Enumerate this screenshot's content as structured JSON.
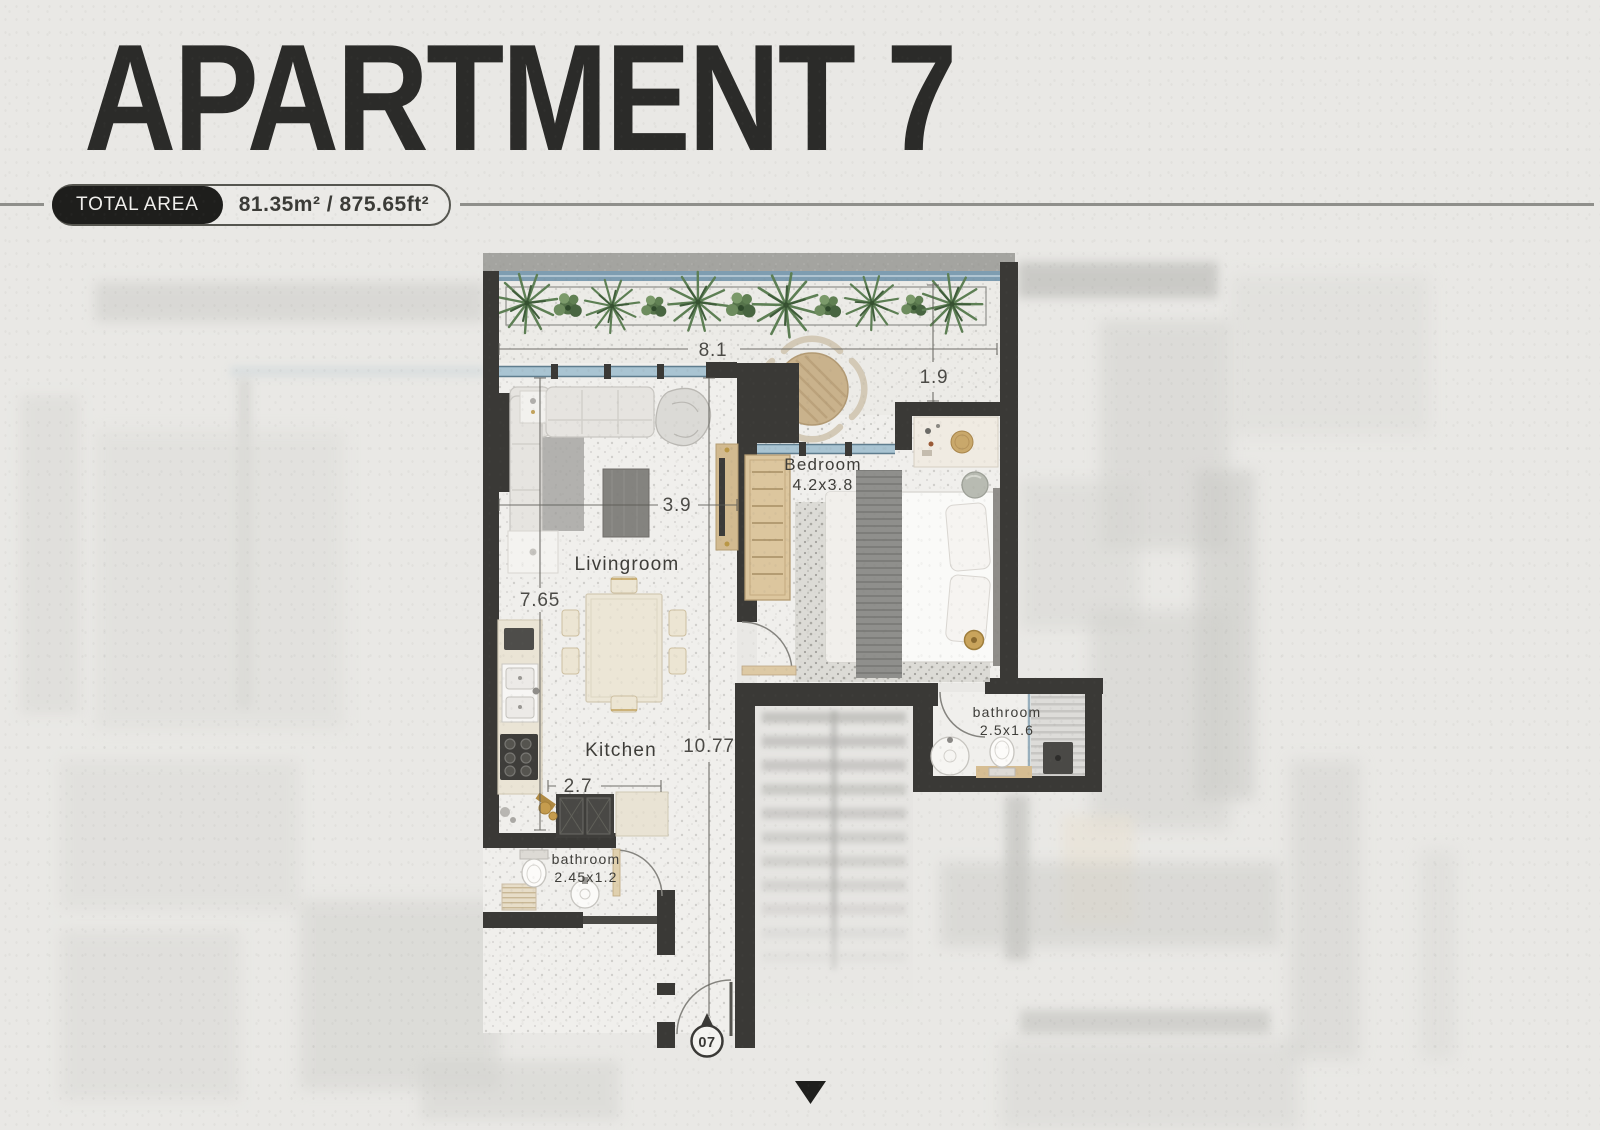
{
  "header": {
    "title": "APARTMENT 7",
    "total_area_label": "TOTAL AREA",
    "total_area_value": "81.35m² / 875.65ft²"
  },
  "plan": {
    "unit_marker": "07",
    "rooms": [
      {
        "id": "livingroom",
        "label": "Livingroom"
      },
      {
        "id": "kitchen",
        "label": "Kitchen"
      },
      {
        "id": "bedroom",
        "label": "Bedroom",
        "size": "4.2x3.8"
      },
      {
        "id": "bathroom-master",
        "label": "bathroom",
        "size": "2.5x1.6"
      },
      {
        "id": "bathroom-guest",
        "label": "bathroom",
        "size": "2.45x1.2"
      }
    ],
    "dimensions": {
      "balcony_width": "8.1",
      "balcony_depth": "1.9",
      "living_width": "3.9",
      "living_depth": "7.65",
      "apartment_depth": "10.77",
      "kitchen_width": "2.7"
    }
  },
  "palette": {
    "background": "#e9e8e5",
    "wall": "#3a3936",
    "floor": "#f0efec",
    "glass": "#7e9db1",
    "plant_green": "#5d7f54",
    "wood": "#cdb58c",
    "title_text": "#2b2b29",
    "label_text": "#3e3d39"
  }
}
